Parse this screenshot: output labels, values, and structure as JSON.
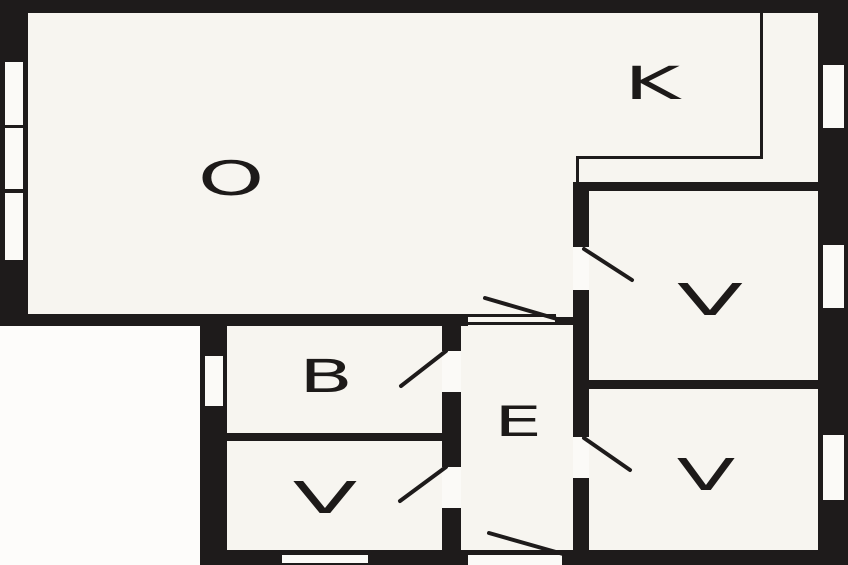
{
  "colors": {
    "wall": "#1e1b1b",
    "floor": "#f7f5f0",
    "outside": "#fdfcfa",
    "opening": "#fbfaf7",
    "label": "#1d1a19"
  },
  "canvas": {
    "width": 848,
    "height": 565
  },
  "rooms": [
    {
      "id": "room-o-living",
      "label": "O",
      "cx": 231,
      "cy": 178,
      "font_size": 47,
      "stretch": 1.8
    },
    {
      "id": "room-k-kitchen",
      "label": "K",
      "cx": 652,
      "cy": 83,
      "font_size": 45,
      "stretch": 1.9
    },
    {
      "id": "room-v-top-right",
      "label": "V",
      "cx": 710,
      "cy": 299,
      "font_size": 44,
      "stretch": 2.2
    },
    {
      "id": "room-v-bottom-right",
      "label": "V",
      "cx": 706,
      "cy": 474,
      "font_size": 44,
      "stretch": 1.95
    },
    {
      "id": "room-b",
      "label": "B",
      "cx": 326,
      "cy": 376,
      "font_size": 45,
      "stretch": 1.75
    },
    {
      "id": "room-e-hallway",
      "label": "E",
      "cx": 518,
      "cy": 421,
      "font_size": 42,
      "stretch": 1.8
    },
    {
      "id": "room-v-bottom-left",
      "label": "V",
      "cx": 325,
      "cy": 497,
      "font_size": 44,
      "stretch": 2.15
    }
  ],
  "outside_areas": [
    {
      "name": "outside-bottom-left",
      "x": 0,
      "y": 326,
      "w": 200,
      "h": 239
    }
  ],
  "walls": [
    {
      "name": "wall-top",
      "x": 0,
      "y": 0,
      "w": 848,
      "h": 13
    },
    {
      "name": "wall-left",
      "x": 0,
      "y": 0,
      "w": 28,
      "h": 326
    },
    {
      "name": "wall-right",
      "x": 818,
      "y": 0,
      "w": 30,
      "h": 565
    },
    {
      "name": "wall-o-bottom",
      "x": 0,
      "y": 314,
      "w": 468,
      "h": 12
    },
    {
      "name": "wall-opening-stub",
      "x": 555,
      "y": 317,
      "w": 18,
      "h": 8
    },
    {
      "name": "wall-hall-left",
      "x": 442,
      "y": 314,
      "w": 19,
      "h": 243
    },
    {
      "name": "wall-lower-left",
      "x": 200,
      "y": 314,
      "w": 27,
      "h": 251
    },
    {
      "name": "wall-b-v-divider",
      "x": 225,
      "y": 433,
      "w": 218,
      "h": 8
    },
    {
      "name": "wall-kitchen-bottom",
      "x": 573,
      "y": 182,
      "w": 247,
      "h": 9
    },
    {
      "name": "wall-hall-right",
      "x": 573,
      "y": 182,
      "w": 16,
      "h": 375
    },
    {
      "name": "wall-v-v-divider",
      "x": 588,
      "y": 380,
      "w": 234,
      "h": 9
    },
    {
      "name": "wall-bottom",
      "x": 200,
      "y": 550,
      "w": 648,
      "h": 15
    }
  ],
  "thin_lines": [
    {
      "name": "kitchen-boundary-vertical",
      "x": 760,
      "y": 13,
      "w": 3,
      "h": 145
    },
    {
      "name": "kitchen-boundary-horizontal",
      "x": 576,
      "y": 156,
      "w": 187,
      "h": 3
    },
    {
      "name": "kitchen-boundary-corner",
      "x": 576,
      "y": 156,
      "w": 3,
      "h": 28
    },
    {
      "name": "o-hall-opening-top-line",
      "x": 466,
      "y": 314,
      "w": 90,
      "h": 3
    },
    {
      "name": "o-hall-opening-bottom-line",
      "x": 466,
      "y": 322,
      "w": 90,
      "h": 3
    }
  ],
  "windows": [
    {
      "name": "window-left-1",
      "x": 5,
      "y": 62,
      "w": 18,
      "h": 63
    },
    {
      "name": "window-left-2",
      "x": 5,
      "y": 128,
      "w": 18,
      "h": 61
    },
    {
      "name": "window-left-3",
      "x": 5,
      "y": 193,
      "w": 18,
      "h": 67
    },
    {
      "name": "window-right-1",
      "x": 823,
      "y": 65,
      "w": 21,
      "h": 63
    },
    {
      "name": "window-right-2",
      "x": 823,
      "y": 245,
      "w": 21,
      "h": 63
    },
    {
      "name": "window-right-3",
      "x": 823,
      "y": 435,
      "w": 21,
      "h": 65
    },
    {
      "name": "window-b-left",
      "x": 205,
      "y": 356,
      "w": 18,
      "h": 50
    },
    {
      "name": "window-bottom",
      "x": 282,
      "y": 555,
      "w": 86,
      "h": 8
    }
  ],
  "door_openings": [
    {
      "name": "door-opening-b",
      "x": 442,
      "y": 351,
      "w": 19,
      "h": 41
    },
    {
      "name": "door-opening-v-bottom-left",
      "x": 442,
      "y": 467,
      "w": 19,
      "h": 41
    },
    {
      "name": "door-opening-v-top-right",
      "x": 573,
      "y": 247,
      "w": 16,
      "h": 43
    },
    {
      "name": "door-opening-v-bottom-right",
      "x": 573,
      "y": 437,
      "w": 16,
      "h": 41
    },
    {
      "name": "entrance-opening",
      "x": 468,
      "y": 555,
      "w": 94,
      "h": 10
    }
  ],
  "door_swings": [
    {
      "name": "door-swing-o-hall",
      "x1": 485,
      "y1": 298,
      "x2": 557,
      "y2": 319
    },
    {
      "name": "door-swing-b",
      "x1": 446,
      "y1": 351,
      "x2": 401,
      "y2": 386
    },
    {
      "name": "door-swing-v-bottom-left",
      "x1": 446,
      "y1": 467,
      "x2": 400,
      "y2": 501
    },
    {
      "name": "door-swing-v-top-right",
      "x1": 584,
      "y1": 249,
      "x2": 632,
      "y2": 280
    },
    {
      "name": "door-swing-v-bottom-right",
      "x1": 584,
      "y1": 438,
      "x2": 630,
      "y2": 470
    },
    {
      "name": "door-swing-entrance",
      "x1": 489,
      "y1": 533,
      "x2": 563,
      "y2": 554
    }
  ]
}
